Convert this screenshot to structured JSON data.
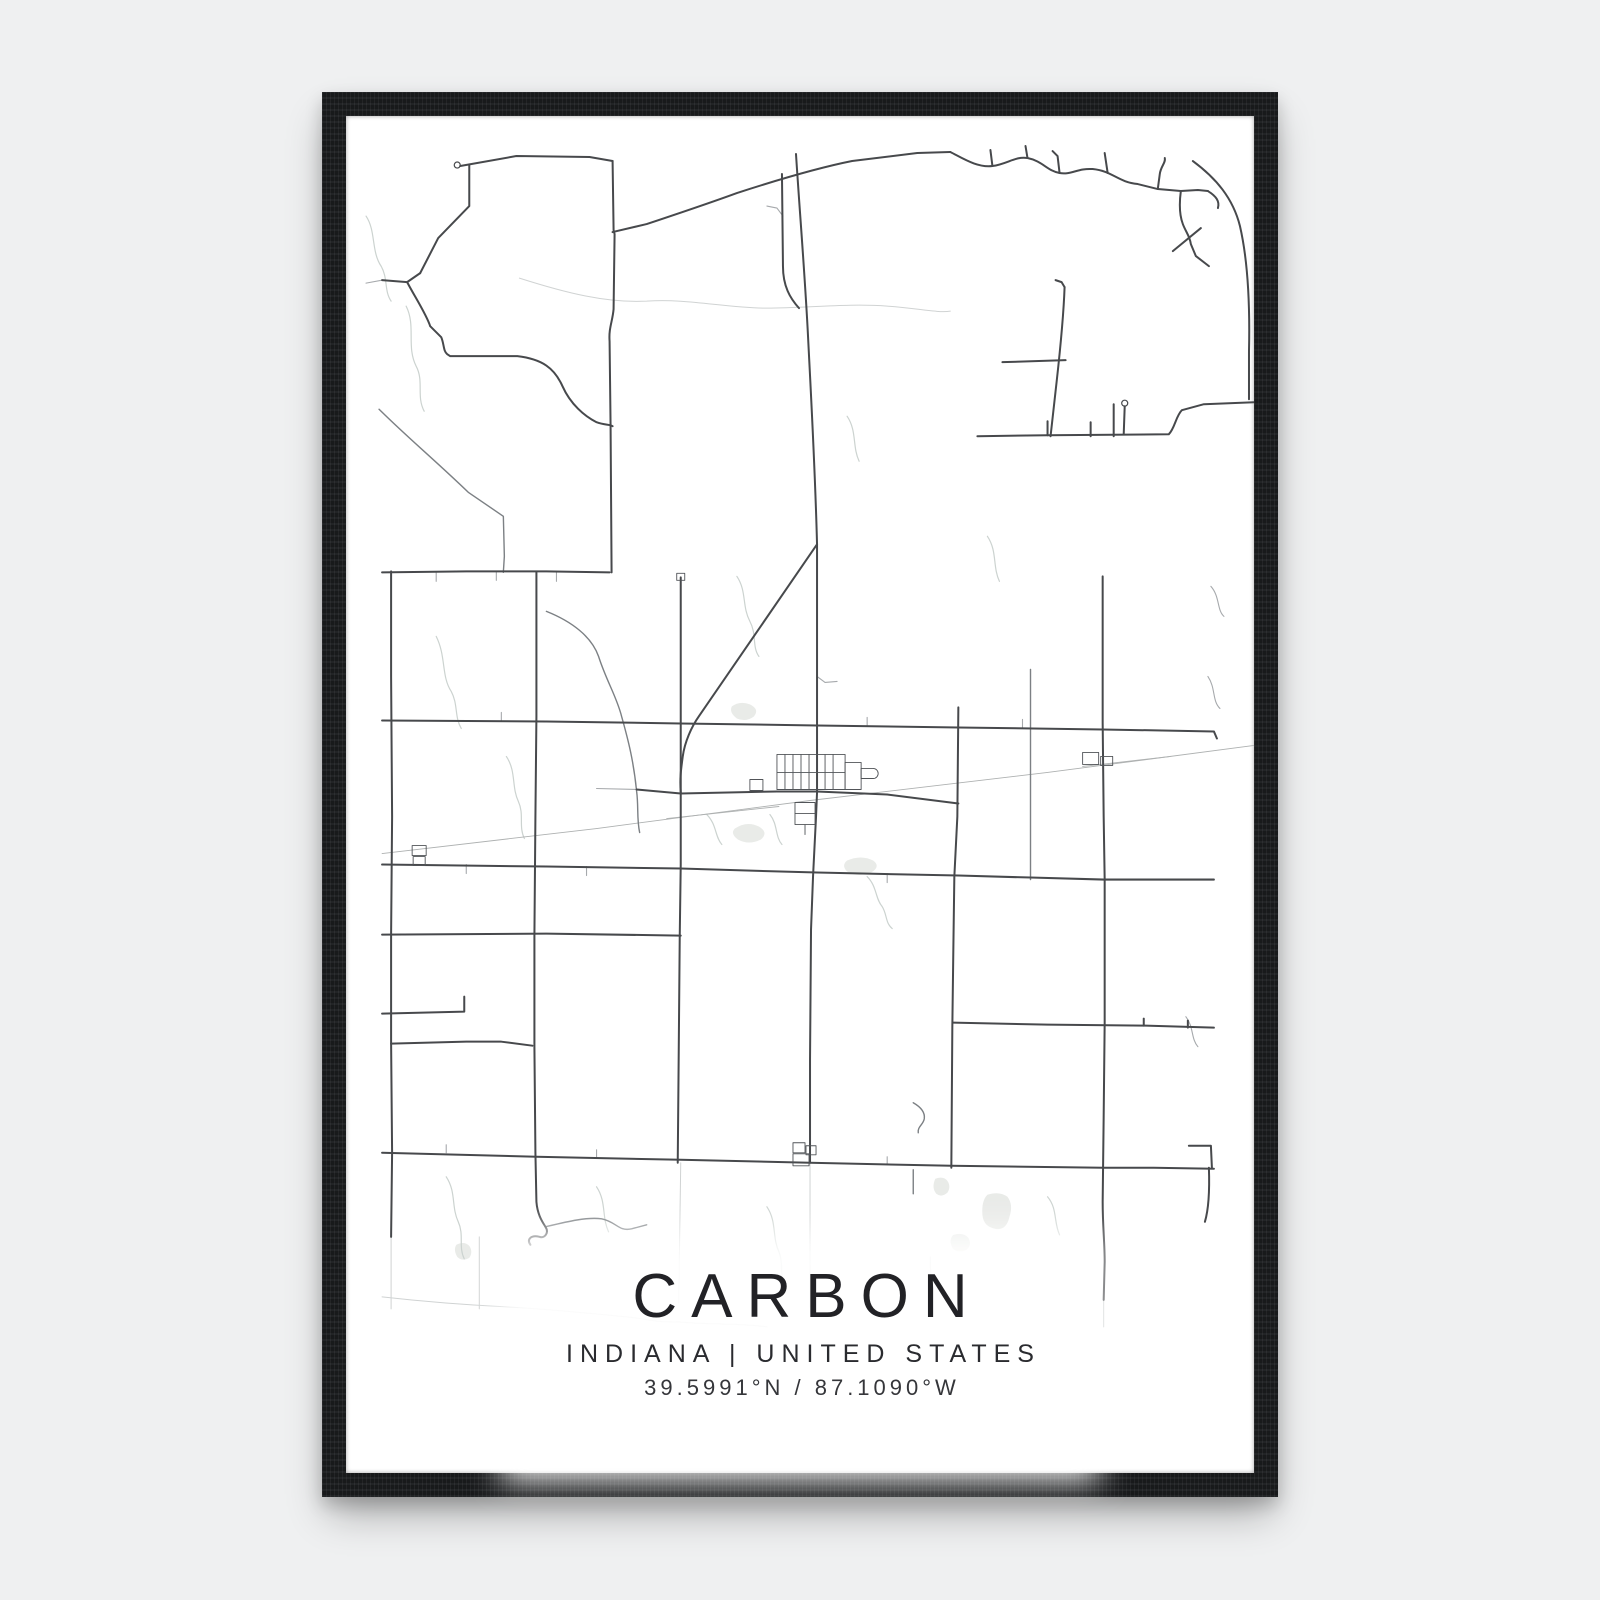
{
  "poster": {
    "title": "CARBON",
    "subtitle": "INDIANA | UNITED STATES",
    "coordinates": "39.5991°N / 87.1090°W"
  },
  "colors": {
    "page_background": "#eff0f1",
    "frame": "#1b1d1f",
    "poster_background": "#ffffff",
    "primary_road": "#47494c",
    "secondary_road": "#7c8084",
    "minor_road": "#a6a9ac",
    "faint_road": "#d0d3d3",
    "railroad": "#aeb1b1",
    "water": "#ccd3d0",
    "lake_fill": "#e9ebe8",
    "text": "#222226"
  },
  "map": {
    "viewbox": "0 0 906 1356",
    "paths": [
      {
        "c": "lake",
        "d": "M385,590 q8,-6 18,-2 q10,5 4,12 q-8,6 -17,2 q-8,-6 -5,-12 z"
      },
      {
        "c": "lake",
        "d": "M500,744 q14,-6 26,0 q8,6 -2,12 q-14,5 -24,-1 q-6,-6 0,-11 z"
      },
      {
        "c": "lake",
        "d": "M388,712 q12,-8 24,-2 q10,6 2,13 q-12,6 -23,0 q-8,-6 -3,-11 z"
      },
      {
        "c": "lake",
        "d": "M640,1078 q12,-4 20,2 q6,8 2,20 q-3,14 -14,12 q-12,-2 -13,-14 q-1,-14 5,-20 z"
      },
      {
        "c": "lake",
        "d": "M588,1062 q8,-3 12,2 q4,6 0,12 q-6,5 -11,1 q-5,-6 -1,-15 z"
      },
      {
        "c": "lake",
        "d": "M606,1118 q10,-3 15,3 q4,7 -2,12 q-9,4 -14,-2 q-4,-8 1,-13 z"
      },
      {
        "c": "lake",
        "d": "M110,1128 q8,-4 13,1 q4,6 0,12 q-7,4 -12,-1 q-4,-7 -1,-12 z"
      },
      {
        "c": "wtr",
        "d": "M60,190 C70,210 60,230 70,250 C78,265 70,280 78,295"
      },
      {
        "c": "wtr",
        "d": "M20,100 C30,115 25,135 35,150 C42,162 38,175 45,185"
      },
      {
        "c": "wtr",
        "d": "M90,520 C100,540 95,560 105,575 C112,588 108,600 115,612"
      },
      {
        "c": "wtr",
        "d": "M390,460 C400,475 395,490 403,505 C410,518 405,530 412,540"
      },
      {
        "c": "wtr",
        "d": "M500,300 C510,315 505,330 512,345"
      },
      {
        "c": "wtr",
        "d": "M360,698 C370,708 368,720 375,728"
      },
      {
        "c": "wtr",
        "d": "M423,698 C431,708 428,720 435,728"
      },
      {
        "c": "wtr",
        "d": "M520,760 C530,770 528,782 535,790 C540,798 538,806 545,812"
      },
      {
        "c": "wtr",
        "d": "M100,1060 C110,1075 105,1090 112,1105 C118,1118 112,1130 118,1142"
      },
      {
        "c": "wtr",
        "d": "M250,1070 C260,1085 255,1100 262,1115"
      },
      {
        "c": "wtr",
        "d": "M420,1090 C430,1105 425,1120 432,1135 C437,1147 432,1158 438,1166"
      },
      {
        "c": "wtr",
        "d": "M700,1080 C710,1092 706,1105 712,1118"
      },
      {
        "c": "wtr",
        "d": "M640,420 C650,435 645,450 652,465"
      },
      {
        "c": "wtr",
        "d": "M160,640 C170,655 165,670 172,685 C178,698 172,710 178,722"
      },
      {
        "c": "r4",
        "d": "M173,162 C220,177 260,187 300,185 C340,182 380,192 420,192 C460,192 500,187 540,190 C570,192 590,197 603,195"
      },
      {
        "c": "r4",
        "d": "M36,1180 C80,1185 120,1188 160,1190 C200,1192 240,1196 280,1200 C300,1202 312,1206 332,1205"
      },
      {
        "c": "r4",
        "d": "M332,1205 C360,1208 390,1206 420,1210"
      },
      {
        "c": "r4",
        "d": "M45,1120 L45,1192"
      },
      {
        "c": "r4",
        "d": "M133,1120 L133,1192"
      },
      {
        "c": "r4",
        "d": "M334,1046 L332,1186"
      },
      {
        "c": "r4",
        "d": "M463,1046 L463,1190"
      },
      {
        "c": "r4",
        "d": "M583,1140 L584,1192"
      },
      {
        "c": "r4",
        "d": "M756,1183 L756,1210"
      },
      {
        "c": "rail",
        "d": "M36,737 L250,712 L463,684 L700,656 L906,629"
      },
      {
        "c": "rail",
        "d": "M320,702 L432,690"
      },
      {
        "c": "rail",
        "d": "M735,650 L823,640"
      },
      {
        "c": "r3",
        "d": "M250,672 L290,673"
      },
      {
        "c": "r3",
        "d": "M36,164 L20,167"
      },
      {
        "c": "r3",
        "d": "M155,605 L155,596"
      },
      {
        "c": "r3",
        "d": "M520,610 L520,601"
      },
      {
        "c": "r3",
        "d": "M675,612 L675,603"
      },
      {
        "c": "r3",
        "d": "M90,456 L90,465"
      },
      {
        "c": "r3",
        "d": "M150,455 L150,464"
      },
      {
        "c": "r3",
        "d": "M210,456 L210,465"
      },
      {
        "c": "r3",
        "d": "M120,748 L120,757"
      },
      {
        "c": "r3",
        "d": "M240,750 L240,759"
      },
      {
        "c": "r3",
        "d": "M540,757 L540,766"
      },
      {
        "c": "r3",
        "d": "M100,1036 L100,1028"
      },
      {
        "c": "r3",
        "d": "M250,1041 L250,1033"
      },
      {
        "c": "r3",
        "d": "M540,1048 L540,1040"
      },
      {
        "c": "r3",
        "d": "M863,470 C872,480 869,494 876,500"
      },
      {
        "c": "r3",
        "d": "M860,560 C868,572 864,584 872,592"
      },
      {
        "c": "r3",
        "d": "M838,900 C846,910 843,922 850,930"
      },
      {
        "c": "r3",
        "d": "M470,560 L478,566 L490,565"
      },
      {
        "c": "r3",
        "d": "M436,100 L430,92 L420,90"
      },
      {
        "c": "r2",
        "d": "M200,495 C225,505 245,520 252,540 C260,565 270,580 275,600 C282,625 287,645 290,675 C292,690 290,702 293,716"
      },
      {
        "c": "r2",
        "d": "M33,293 C60,320 90,345 122,376 L157,400 L158,440 L157,456"
      },
      {
        "c": "r2",
        "d": "M566,986 C573,990 578,995 577,1002 C576,1008 570,1010 571,1016"
      },
      {
        "c": "r2",
        "d": "M566,1053 L566,1077"
      },
      {
        "c": "r2",
        "d": "M199,1110 C220,1105 240,1100 255,1102 C270,1105 272,1115 285,1112 L300,1108"
      },
      {
        "c": "r2",
        "d": "M683,553 L683,680 L683,763"
      },
      {
        "c": "r1",
        "d": "M449,38 C453,100 458,160 461,220 C464,280 468,350 470,428"
      },
      {
        "c": "r1",
        "d": "M470,428 L352,600 C345,610 338,625 336,640 C334,655 333,662 334,676"
      },
      {
        "c": "r1",
        "d": "M334,461 L334,676 L334,748 L333,820 L332,935 L331,1046"
      },
      {
        "c": "r1",
        "d": "M470,428 L470,606 L470,637 L470,676 L469,700 L466,760 L464,813 L463,943 L463,1046"
      },
      {
        "c": "r1",
        "d": "M435,58 L436,150 C436,170 443,182 452,192"
      },
      {
        "c": "r1",
        "d": "M266,45 L267,114 L268,118 L267,193 C266,205 262,212 263,225 L264,310 L265,456"
      },
      {
        "c": "r1",
        "d": "M114,50 L170,40 L243,41 L266,45"
      },
      {
        "c": "r1",
        "d": "M123,49 L123,90 L92,122 L74,157"
      },
      {
        "c": "r1",
        "d": "M74,157 L61,166 L36,164"
      },
      {
        "c": "r1",
        "d": "M61,166 C70,183 80,198 84,210 L95,221 C98,228 97,235 101,238 L104,240 L171,240 C196,243 208,252 216,270 C224,288 238,300 250,306 C258,309 263,308 266,310"
      },
      {
        "c": "r1",
        "d": "M266,116 L300,108 C330,98 360,88 390,77 C430,64 470,52 505,45 L570,37 L603,36"
      },
      {
        "c": "r1",
        "d": "M603,36 C615,42 630,52 645,50 C660,48 668,40 680,42 C695,45 700,55 712,57 C724,59 730,52 745,53 C765,55 770,66 790,68 L810,73 L833,75 L850,74 L860,75"
      },
      {
        "c": "r1",
        "d": "M760,57 L757,37"
      },
      {
        "c": "r1",
        "d": "M712,57 L710,40 L705,35"
      },
      {
        "c": "r1",
        "d": "M645,50 L643,34"
      },
      {
        "c": "r1",
        "d": "M680,42 L678,30"
      },
      {
        "c": "r1",
        "d": "M810,73 L812,58 C813,50 818,47 817,42"
      },
      {
        "c": "r1",
        "d": "M833,75 C831,90 832,100 835,108 C838,116 842,120 843,128 L848,140 L861,150"
      },
      {
        "c": "r1",
        "d": "M825,135 L853,112"
      },
      {
        "c": "r1",
        "d": "M860,75 C868,80 872,85 870,92"
      },
      {
        "c": "r1",
        "d": "M845,45 C868,62 885,82 892,110 C900,145 902,190 901,235 L901,283"
      },
      {
        "c": "r1",
        "d": "M630,320 L700,319 L821,318 C827,312 828,300 834,294 L856,288 L906,286"
      },
      {
        "c": "r1",
        "d": "M766,320 L766,288"
      },
      {
        "c": "r1",
        "d": "M776,318 L777,290"
      },
      {
        "c": "r1",
        "d": "M743,320 L743,306"
      },
      {
        "c": "r1",
        "d": "M700,319 L700,305"
      },
      {
        "c": "r1",
        "d": "M717,171 C716,200 712,240 708,275 L703,320"
      },
      {
        "c": "r1",
        "d": "M717,171 L714,166 L708,164"
      },
      {
        "c": "r1",
        "d": "M655,246 L718,244"
      },
      {
        "c": "r1",
        "d": "M36,456 L120,455 L200,455 L263,456"
      },
      {
        "c": "r1",
        "d": "M45,455 L45,560 L46,700 L45,818 L45,926 L46,1036 L45,1120"
      },
      {
        "c": "r1",
        "d": "M36,604 L200,605 L334,607 L470,609 L611,611 L755,613 L866,615 L869,622"
      },
      {
        "c": "r1",
        "d": "M290,673 L334,677 L430,675 L470,675 L540,678 L611,687"
      },
      {
        "c": "r1",
        "d": "M36,748 L200,750 L334,752 L470,756 L611,759 L683,761 L756,763 L866,763"
      },
      {
        "c": "r1",
        "d": "M36,818 L200,817 L334,819"
      },
      {
        "c": "r1",
        "d": "M36,897 L118,895 L118,880"
      },
      {
        "c": "r1",
        "d": "M45,927 L120,925 L155,925 L186,929"
      },
      {
        "c": "r1",
        "d": "M190,456 L190,600 L189,700 L188,819 L188,930 L189,1036 L190,1085 C191,1098 196,1105 199,1110 C203,1116 198,1122 193,1120 C185,1118 180,1122 184,1128"
      },
      {
        "c": "r1",
        "d": "M611,591 L610,700 L607,760 L606,833 L605,910 L604,1051"
      },
      {
        "c": "r1",
        "d": "M755,460 L755,606 L756,700 L757,763 L757,906 L756,1000 L755,1085 C755,1110 757,1125 757,1145 L756,1183"
      },
      {
        "c": "r1",
        "d": "M606,906 L700,908 L798,909 L866,911"
      },
      {
        "c": "r1",
        "d": "M796,902 L796,909"
      },
      {
        "c": "r1",
        "d": "M840,904 L840,911"
      },
      {
        "c": "r1",
        "d": "M36,1036 L190,1040 L334,1043 L463,1046 L604,1049 L756,1051 L806,1051 L866,1052"
      },
      {
        "c": "r1",
        "d": "M841,1029 L863,1029 L864,1051"
      },
      {
        "c": "r1",
        "d": "M861,1051 C862,1080 860,1095 857,1105"
      },
      {
        "c": "bld",
        "d": "M430,638 h68 v35 h-68 z"
      },
      {
        "c": "bld",
        "d": "M438,638 V673"
      },
      {
        "c": "bld",
        "d": "M446,638 V673"
      },
      {
        "c": "bld",
        "d": "M454,638 V673"
      },
      {
        "c": "bld",
        "d": "M462,638 V673"
      },
      {
        "c": "bld",
        "d": "M478,638 V673"
      },
      {
        "c": "bld",
        "d": "M486,638 V673"
      },
      {
        "c": "bld",
        "d": "M430,656 H498"
      },
      {
        "c": "bld",
        "d": "M498,646 h16 v27 h-16 z"
      },
      {
        "c": "bld",
        "d": "M514,652 h12 a5,5 0 0 1 0,10 h-12 z"
      },
      {
        "c": "bld",
        "d": "M448,686 h20 v22 h-20 z"
      },
      {
        "c": "bld",
        "d": "M448,697 h20"
      },
      {
        "c": "bld",
        "d": "M458,708 v10"
      },
      {
        "c": "bld",
        "d": "M403,663 h13 v11 h-13 z"
      },
      {
        "c": "bld",
        "d": "M330,457 h8 v7 h-8 z"
      },
      {
        "c": "bld",
        "d": "M735,636 h16 v12 h-16 z"
      },
      {
        "c": "bld",
        "d": "M753,640 h12 v9 h-12 z"
      },
      {
        "c": "bld",
        "d": "M66,729 h14 v10 h-14 z"
      },
      {
        "c": "bld",
        "d": "M67,740 h12 v9 h-12 z"
      },
      {
        "c": "bld",
        "d": "M446,1026 h12 v10 h-12 z"
      },
      {
        "c": "bld",
        "d": "M446,1037 h16 v12 h-16 z"
      },
      {
        "c": "bld",
        "d": "M459,1029 h10 v9 h-10 z"
      }
    ],
    "circles": [
      {
        "x": 111,
        "y": 49,
        "r": 3
      },
      {
        "x": 777,
        "y": 287,
        "r": 3
      }
    ]
  }
}
